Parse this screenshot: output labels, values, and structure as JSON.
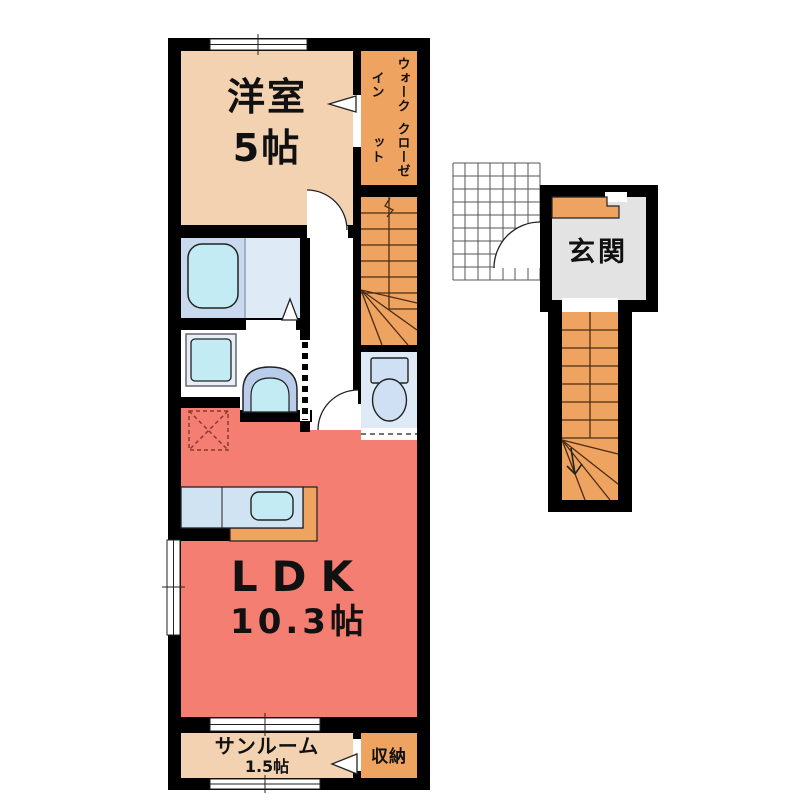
{
  "plan": {
    "title": "apartment-floor-plan",
    "rooms": {
      "western_room": {
        "name": "洋室",
        "size": "5帖"
      },
      "walk_in_closet": {
        "name_line1": "ウォークイン",
        "name_line2": "クローゼット"
      },
      "entrance": {
        "name": "玄関"
      },
      "ldk": {
        "name": "LDK",
        "size": "10.3帖"
      },
      "sunroom": {
        "name": "サンルーム",
        "size": "1.5帖"
      },
      "storage": {
        "name": "収納"
      }
    },
    "colors": {
      "room_beige": "#f3d2b2",
      "closet_orange": "#efa360",
      "ldk_red": "#f47e71",
      "entrance_gray": "#e3e3e3",
      "bath_blue": "#dfeaf7",
      "bath_blue_dark": "#c9d9ee",
      "fixture_cyan": "#c2ebf3",
      "fixture_blue": "#cfe0f5",
      "kitchen_blue": "#cfe3f3",
      "wall_black": "#000000"
    }
  }
}
